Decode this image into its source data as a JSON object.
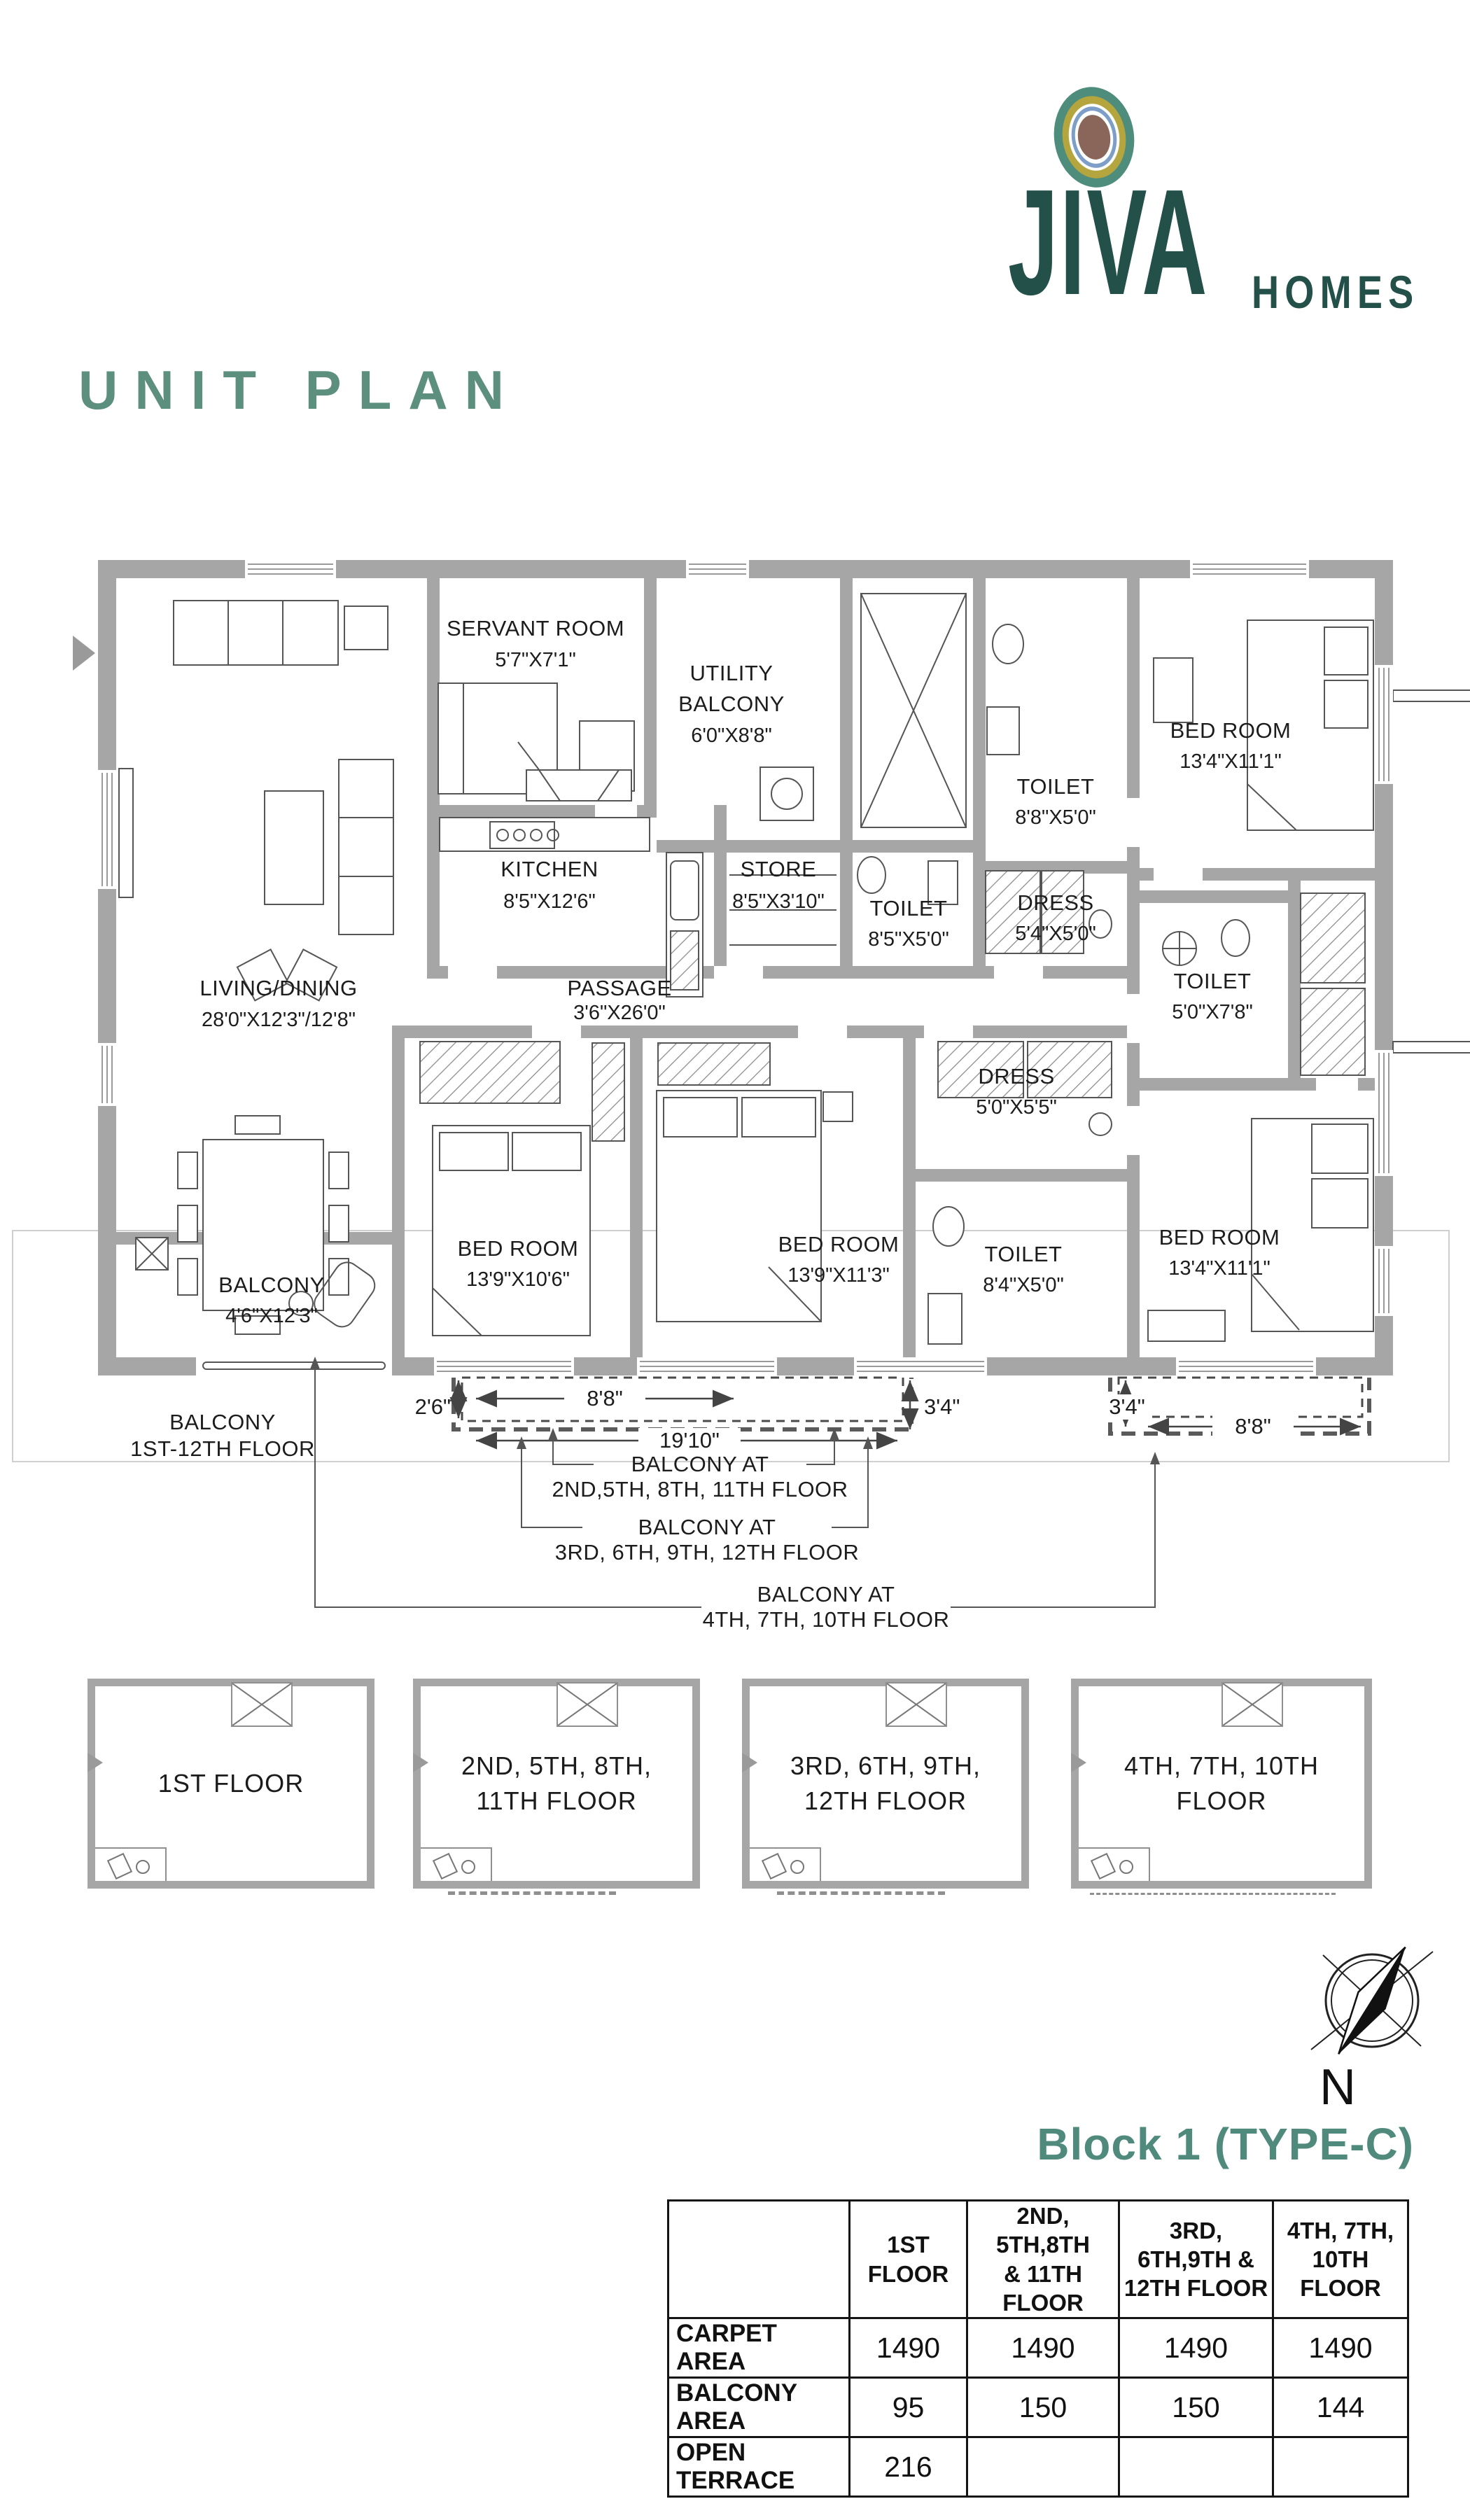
{
  "logo": {
    "brand": "JIVA",
    "suffix": "HOMES"
  },
  "page_title": "UNIT PLAN",
  "plan": {
    "rooms": [
      {
        "l1": "SERVANT ROOM",
        "l2": "",
        "dims": "5'7\"X7'1\""
      },
      {
        "l1": "UTILITY",
        "l2": "BALCONY",
        "dims": "6'0\"X8'8\""
      },
      {
        "l1": "TOILET",
        "l2": "",
        "dims": "8'8\"X5'0\""
      },
      {
        "l1": "BED ROOM",
        "l2": "",
        "dims": "13'4\"X11'1\""
      },
      {
        "l1": "KITCHEN",
        "l2": "",
        "dims": "8'5\"X12'6\""
      },
      {
        "l1": "STORE",
        "l2": "",
        "dims": "8'5\"X3'10\""
      },
      {
        "l1": "TOILET",
        "l2": "",
        "dims": "8'5\"X5'0\""
      },
      {
        "l1": "DRESS",
        "l2": "",
        "dims": "5'4\"X5'0\""
      },
      {
        "l1": "LIVING/DINING",
        "l2": "",
        "dims": "28'0\"X12'3\"/12'8\""
      },
      {
        "l1": "PASSAGE",
        "l2": "",
        "dims": "3'6\"X26'0\""
      },
      {
        "l1": "TOILET",
        "l2": "",
        "dims": "5'0\"X7'8\""
      },
      {
        "l1": "DRESS",
        "l2": "",
        "dims": "5'0\"X5'5\""
      },
      {
        "l1": "BED ROOM",
        "l2": "",
        "dims": "13'9\"X10'6\""
      },
      {
        "l1": "BED ROOM",
        "l2": "",
        "dims": "13'9\"X11'3\""
      },
      {
        "l1": "TOILET",
        "l2": "",
        "dims": "8'4\"X5'0\""
      },
      {
        "l1": "BED ROOM",
        "l2": "",
        "dims": "13'4\"X11'1\""
      },
      {
        "l1": "BALCONY",
        "l2": "",
        "dims": "4'6\"X12'3\""
      }
    ],
    "dims": {
      "left_height": "2'6\"",
      "left_width": "8'8\"",
      "total_width": "19'10\"",
      "mid_depth": "3'4\"",
      "right_depth": "3'4\"",
      "right_width": "8'8\""
    },
    "annotations": {
      "all_floors": {
        "l1": "BALCONY",
        "l2": "1ST-12TH FLOOR"
      },
      "floors_2581": {
        "l1": "BALCONY AT",
        "l2": "2ND,5TH, 8TH, 11TH FLOOR"
      },
      "floors_3691": {
        "l1": "BALCONY AT",
        "l2": "3RD, 6TH, 9TH, 12TH FLOOR"
      },
      "floors_4710": {
        "l1": "BALCONY AT",
        "l2": "4TH, 7TH, 10TH FLOOR"
      }
    },
    "compass_label": "N"
  },
  "thumbnails": [
    {
      "l1": "1ST FLOOR",
      "l2": ""
    },
    {
      "l1": "2ND, 5TH, 8TH,",
      "l2": "11TH FLOOR"
    },
    {
      "l1": "3RD, 6TH, 9TH,",
      "l2": "12TH FLOOR"
    },
    {
      "l1": "4TH, 7TH, 10TH FLOOR",
      "l2": ""
    }
  ],
  "block_heading": "Block 1 (TYPE-C)",
  "area_table": {
    "corner": "",
    "col_headers": [
      "1ST FLOOR",
      "2ND, 5TH,8TH\n& 11TH FLOOR",
      "3RD, 6TH,9TH &\n12TH FLOOR",
      "4TH, 7TH,\n10TH FLOOR"
    ],
    "rows": [
      {
        "label": "CARPET AREA",
        "values": [
          "1490",
          "1490",
          "1490",
          "1490"
        ]
      },
      {
        "label": "BALCONY AREA",
        "values": [
          "95",
          "150",
          "150",
          "144"
        ]
      },
      {
        "label": "OPEN TERRACE",
        "values": [
          "216",
          "",
          "",
          ""
        ]
      }
    ]
  },
  "colors": {
    "teal": "#5D8F7F",
    "dark_teal": "#24504A",
    "wall": "#A6A6A6",
    "olive": "#B5A53F",
    "blue": "#7D9EC7",
    "brown": "#8A655A"
  }
}
